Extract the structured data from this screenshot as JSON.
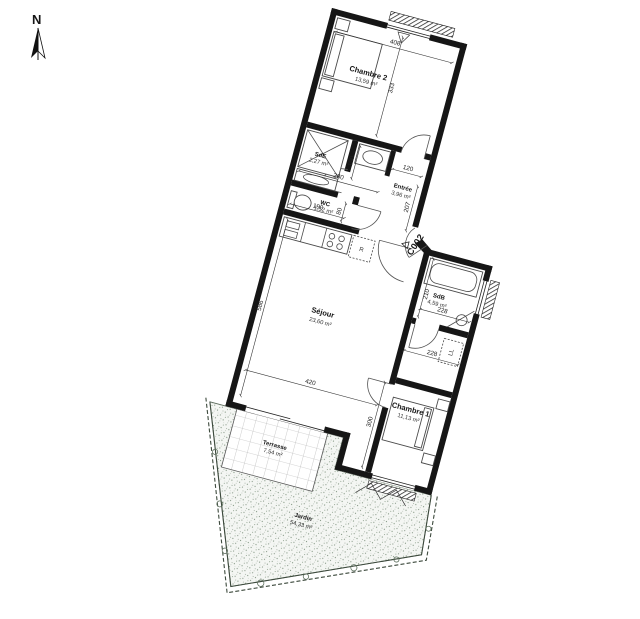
{
  "north": {
    "label": "N"
  },
  "unit": {
    "label": "C002"
  },
  "rooms": {
    "chambre2": {
      "name": "Chambre 2",
      "area": "13,59 m²"
    },
    "sde": {
      "name": "SdE",
      "area": "2,27 m²"
    },
    "entree": {
      "name": "Entrée",
      "area": "3,96 m²"
    },
    "wc": {
      "name": "WC",
      "area": "1,52 m²"
    },
    "sejour": {
      "name": "Séjour",
      "area": "23,60 m²"
    },
    "sdb": {
      "name": "SdB",
      "area": "4,59 m²"
    },
    "chambre1": {
      "name": "Chambre 1",
      "area": "11,13 m²"
    },
    "terrasse": {
      "name": "Terrasse",
      "area": "7,54 m²"
    },
    "jardin": {
      "name": "Jardin",
      "area": "54,33 m²"
    }
  },
  "appliances": {
    "fridge": "R",
    "washer": "LL"
  },
  "dims": {
    "d408": "408",
    "d333": "333",
    "d280": "280",
    "d190a": "190",
    "d120": "120",
    "d207": "207",
    "d190b": "190",
    "d80": "80",
    "d586": "586",
    "d420": "420",
    "d210": "210",
    "d228a": "228",
    "d228b": "228",
    "d300": "300"
  },
  "colors": {
    "wall": "#161616",
    "line": "#4a4a4a",
    "stipple": "#7e937e",
    "accent": "#000000"
  }
}
